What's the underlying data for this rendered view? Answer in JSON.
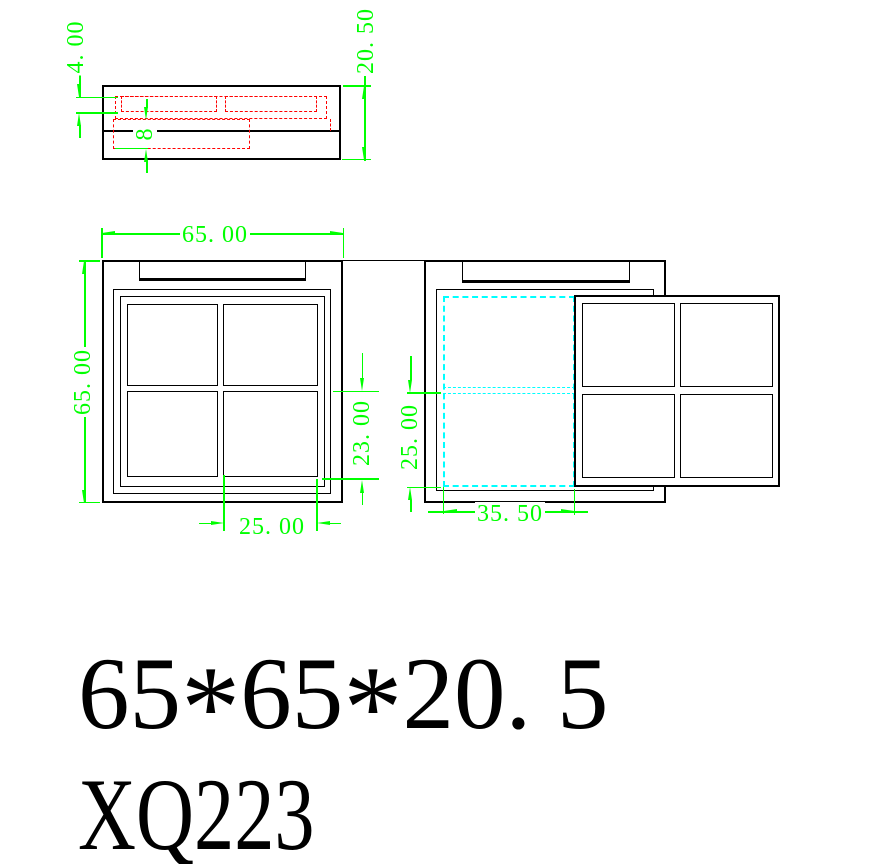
{
  "colors": {
    "dim": "#00ff00",
    "hidden": "#ff0000",
    "slide": "#00ffff",
    "line": "#000000",
    "paper": "#ffffff"
  },
  "dims": {
    "section": {
      "lid_thickness": "4. 00",
      "overall_height": "20. 50",
      "tray_depth": "8"
    },
    "front": {
      "width": "65. 00",
      "height": "65. 00",
      "pane_bottom_offset": "23. 00",
      "pane_width": "25. 00"
    },
    "open": {
      "slide_offset_v": "25. 00",
      "slide_travel": "35. 50"
    }
  },
  "title": {
    "size_segments": [
      "65",
      "*",
      "65",
      "*",
      "20. 5"
    ],
    "model": "XQ223"
  }
}
